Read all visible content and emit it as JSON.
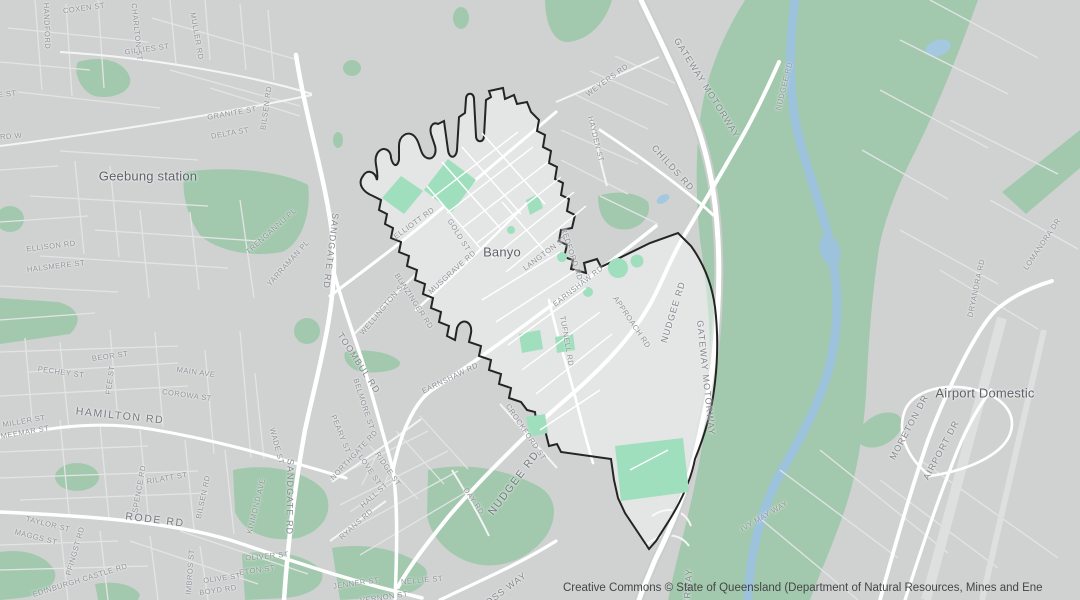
{
  "map": {
    "highlighted_suburb": "Banyo",
    "attribution": "Creative Commons © State of Queensland (Department of Natural Resources, Mines and Ene",
    "colors": {
      "land": "#d0d2d2",
      "park_green": "#a2c9ae",
      "park_green_bright": "#9fdfbe",
      "water_blue": "#9cc2dc",
      "road_white": "#ffffff",
      "boundary_black": "#242424",
      "street_label_gray": "#8e9297",
      "place_label_gray": "#5d6368"
    },
    "labels": [
      {
        "t": "HANDFORD",
        "x": 47,
        "y": 26,
        "r": 88,
        "s": "lx"
      },
      {
        "t": "COXEN ST",
        "x": 84,
        "y": 8,
        "r": -8,
        "s": "lx"
      },
      {
        "t": "CHARLTON ST",
        "x": 137,
        "y": 32,
        "r": 84,
        "s": "lx"
      },
      {
        "t": "MULLER RD",
        "x": 197,
        "y": 36,
        "r": 80,
        "s": "lx"
      },
      {
        "t": "GILLIES ST",
        "x": 147,
        "y": 49,
        "r": -8,
        "s": "lx"
      },
      {
        "t": "GRANITE ST",
        "x": 232,
        "y": 113,
        "r": -10,
        "s": "lx"
      },
      {
        "t": "DELTA ST",
        "x": 230,
        "y": 133,
        "r": -10,
        "s": "lx"
      },
      {
        "t": "IE ST",
        "x": 6,
        "y": 94,
        "r": -6,
        "s": "lx"
      },
      {
        "t": "RD W",
        "x": 11,
        "y": 136,
        "r": -4,
        "s": "lx"
      },
      {
        "t": "Geebung station",
        "x": 148,
        "y": 176,
        "r": 0,
        "s": "ll"
      },
      {
        "t": "ELLISON RD",
        "x": 51,
        "y": 246,
        "r": -7,
        "s": "lx"
      },
      {
        "t": "HALSMERE ST",
        "x": 56,
        "y": 266,
        "r": -7,
        "s": "lx"
      },
      {
        "t": "TRENGANNU PL",
        "x": 271,
        "y": 231,
        "r": -42,
        "s": "lx"
      },
      {
        "t": "YARRAMAN PL",
        "x": 288,
        "y": 263,
        "r": -48,
        "s": "lx"
      },
      {
        "t": "SANDGATE RD",
        "x": 331,
        "y": 251,
        "r": 97,
        "s": "ls"
      },
      {
        "t": "SANDGATE RD",
        "x": 290,
        "y": 497,
        "r": 91,
        "s": "ls"
      },
      {
        "t": "TOOMBUL RD",
        "x": 359,
        "y": 363,
        "r": 57,
        "s": "ls"
      },
      {
        "t": "WELLINGTON ST",
        "x": 383,
        "y": 308,
        "r": -50,
        "s": "lx"
      },
      {
        "t": "BELMORE ST",
        "x": 364,
        "y": 404,
        "r": 72,
        "s": "lx"
      },
      {
        "t": "PEARY ST",
        "x": 341,
        "y": 434,
        "r": 68,
        "s": "lx"
      },
      {
        "t": "WADE ST",
        "x": 277,
        "y": 446,
        "r": 75,
        "s": "lx"
      },
      {
        "t": "KINMOND AVE",
        "x": 256,
        "y": 506,
        "r": -76,
        "s": "lx"
      },
      {
        "t": "SPENCE RD",
        "x": 139,
        "y": 489,
        "r": -80,
        "s": "lx"
      },
      {
        "t": "RILATT ST",
        "x": 167,
        "y": 478,
        "r": -10,
        "s": "lx"
      },
      {
        "t": "BILSEN RD",
        "x": 203,
        "y": 497,
        "r": -78,
        "s": "lx"
      },
      {
        "t": "BILSEN RD",
        "x": 266,
        "y": 108,
        "r": -82,
        "s": "lx"
      },
      {
        "t": "RODE RD",
        "x": 155,
        "y": 520,
        "r": 7,
        "s": "lm"
      },
      {
        "t": "TAYLOR ST",
        "x": 48,
        "y": 524,
        "r": 14,
        "s": "lx"
      },
      {
        "t": "MAGGS ST",
        "x": 36,
        "y": 537,
        "r": 14,
        "s": "lx"
      },
      {
        "t": "PFINGST RD",
        "x": 75,
        "y": 551,
        "r": -74,
        "s": "lx"
      },
      {
        "t": "EDINBURGH CASTLE RD",
        "x": 80,
        "y": 580,
        "r": -17,
        "s": "lx"
      },
      {
        "t": "IMBROS ST",
        "x": 190,
        "y": 572,
        "r": -86,
        "s": "lx"
      },
      {
        "t": "OLIVER ST",
        "x": 267,
        "y": 556,
        "r": -5,
        "s": "lx"
      },
      {
        "t": "ETON ST",
        "x": 257,
        "y": 570,
        "r": -8,
        "s": "lx"
      },
      {
        "t": "OLIVE ST",
        "x": 222,
        "y": 578,
        "r": -8,
        "s": "lx"
      },
      {
        "t": "BOYD RD",
        "x": 218,
        "y": 590,
        "r": -8,
        "s": "lx"
      },
      {
        "t": "MILLER ST",
        "x": 24,
        "y": 421,
        "r": -10,
        "s": "lx"
      },
      {
        "t": "MEEMAR ST",
        "x": 25,
        "y": 432,
        "r": -10,
        "s": "lx"
      },
      {
        "t": "HAMILTON RD",
        "x": 120,
        "y": 416,
        "r": 6,
        "s": "lm"
      },
      {
        "t": "PECHEY ST",
        "x": 61,
        "y": 372,
        "r": 8,
        "s": "lx"
      },
      {
        "t": "BEOR ST",
        "x": 110,
        "y": 356,
        "r": -8,
        "s": "lx"
      },
      {
        "t": "FEE ST",
        "x": 110,
        "y": 380,
        "r": -82,
        "s": "lx"
      },
      {
        "t": "MAIN AVE",
        "x": 196,
        "y": 372,
        "r": 8,
        "s": "lx"
      },
      {
        "t": "COROWA ST",
        "x": 187,
        "y": 395,
        "r": 8,
        "s": "lx"
      },
      {
        "t": "NORTHGATE RD",
        "x": 354,
        "y": 455,
        "r": -47,
        "s": "lx"
      },
      {
        "t": "LOVE ST",
        "x": 370,
        "y": 470,
        "r": 56,
        "s": "lx"
      },
      {
        "t": "RIDGE ST",
        "x": 388,
        "y": 469,
        "r": 56,
        "s": "lx"
      },
      {
        "t": "HALL ST",
        "x": 374,
        "y": 495,
        "r": -42,
        "s": "lx"
      },
      {
        "t": "RYANS RD",
        "x": 356,
        "y": 524,
        "r": -42,
        "s": "lx"
      },
      {
        "t": "DAY RD",
        "x": 474,
        "y": 501,
        "r": 56,
        "s": "lx"
      },
      {
        "t": "NELLIE ST",
        "x": 422,
        "y": 580,
        "r": -5,
        "s": "lx"
      },
      {
        "t": "JENNER ST",
        "x": 356,
        "y": 583,
        "r": -8,
        "s": "lx"
      },
      {
        "t": "VERNON ST",
        "x": 384,
        "y": 597,
        "r": -8,
        "s": "lx"
      },
      {
        "t": "ROSS WAY",
        "x": 503,
        "y": 591,
        "r": -37,
        "s": "ls"
      },
      {
        "t": "NUDGEE RD",
        "x": 514,
        "y": 483,
        "r": -53,
        "s": "lm"
      },
      {
        "t": "NUDGEE RD",
        "x": 673,
        "y": 312,
        "r": -73,
        "s": "ls"
      },
      {
        "t": "NUDGEE RD",
        "x": 784,
        "y": 86,
        "r": -76,
        "s": "lx"
      },
      {
        "t": "GATEWAY MOTORWAY",
        "x": 707,
        "y": 88,
        "r": 58,
        "s": "ls"
      },
      {
        "t": "GATEWAY MOTORWAY",
        "x": 706,
        "y": 378,
        "r": 84,
        "s": "ls"
      },
      {
        "t": "MOTORWAY",
        "x": 687,
        "y": 599,
        "r": -86,
        "s": "ls"
      },
      {
        "t": "APPROACH RD",
        "x": 632,
        "y": 322,
        "r": 56,
        "s": "lx"
      },
      {
        "t": "EARNSHAW RD",
        "x": 578,
        "y": 286,
        "r": -38,
        "s": "lx"
      },
      {
        "t": "EARNSHAW RD",
        "x": 450,
        "y": 378,
        "r": -26,
        "s": "lx"
      },
      {
        "t": "LANGTON ST",
        "x": 545,
        "y": 253,
        "r": -37,
        "s": "lx"
      },
      {
        "t": "Banyo",
        "x": 502,
        "y": 252,
        "r": 0,
        "s": "ll"
      },
      {
        "t": "MUSGRAVE RD",
        "x": 452,
        "y": 272,
        "r": -42,
        "s": "lx"
      },
      {
        "t": "GOLD ST",
        "x": 459,
        "y": 235,
        "r": 58,
        "s": "lx"
      },
      {
        "t": "ELLIOTT RD",
        "x": 414,
        "y": 223,
        "r": -36,
        "s": "lx"
      },
      {
        "t": "BLINZINGER RD",
        "x": 414,
        "y": 301,
        "r": 57,
        "s": "lx"
      },
      {
        "t": "TUFNELL RD",
        "x": 567,
        "y": 341,
        "r": 80,
        "s": "lx"
      },
      {
        "t": "CROCKFORD ST",
        "x": 526,
        "y": 432,
        "r": 56,
        "s": "lx"
      },
      {
        "t": "HAYDEN ST",
        "x": 596,
        "y": 139,
        "r": 76,
        "s": "lx"
      },
      {
        "t": "CHILDS RD",
        "x": 673,
        "y": 168,
        "r": 48,
        "s": "ls"
      },
      {
        "t": "WEYERS RD",
        "x": 607,
        "y": 80,
        "r": -36,
        "s": "lx"
      },
      {
        "t": "REDFORD RD",
        "x": 572,
        "y": 254,
        "r": 72,
        "s": "lx"
      },
      {
        "t": "DRYANDRA RD",
        "x": 976,
        "y": 288,
        "r": -78,
        "s": "lx"
      },
      {
        "t": "Airport Domestic",
        "x": 985,
        "y": 393,
        "r": 0,
        "s": "ll"
      },
      {
        "t": "MORETON DR",
        "x": 909,
        "y": 427,
        "r": -62,
        "s": "ls"
      },
      {
        "t": "AIRPORT DR",
        "x": 941,
        "y": 450,
        "r": -62,
        "s": "ls"
      },
      {
        "t": "IVY MAY WAY",
        "x": 764,
        "y": 516,
        "r": -30,
        "s": "lx"
      },
      {
        "t": "LOMANDRA DR",
        "x": 1042,
        "y": 244,
        "r": -56,
        "s": "lx"
      }
    ]
  }
}
